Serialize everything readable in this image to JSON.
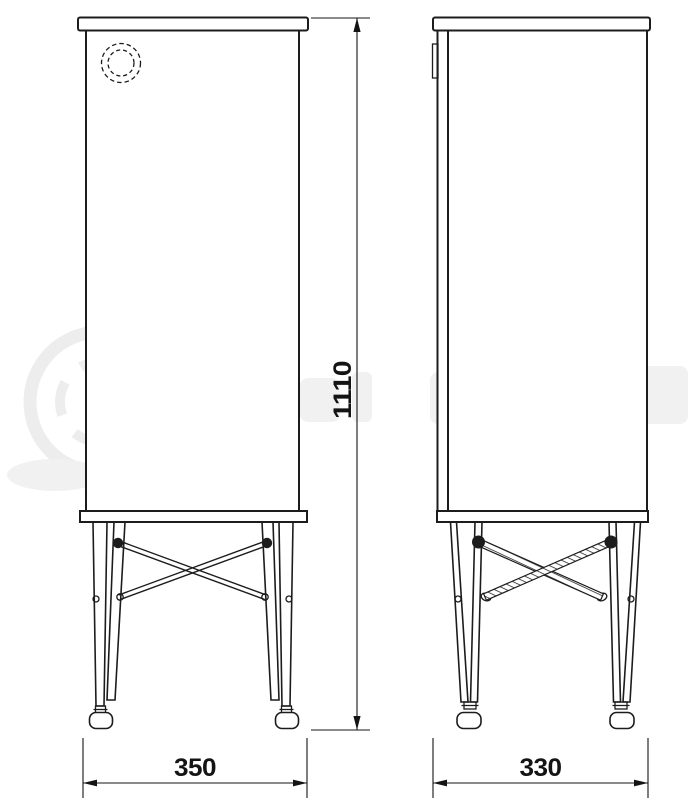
{
  "drawing": {
    "background": "#ffffff",
    "line_color": "#1c1c1c",
    "dimension_color": "#141414",
    "dimensions": {
      "overall_height": {
        "value": "1110",
        "orientation": "vertical"
      },
      "front_width": {
        "value": "350",
        "orientation": "horizontal"
      },
      "side_depth": {
        "value": "330",
        "orientation": "horizontal"
      }
    }
  },
  "watermark": {
    "color": "#f0f0f0"
  }
}
